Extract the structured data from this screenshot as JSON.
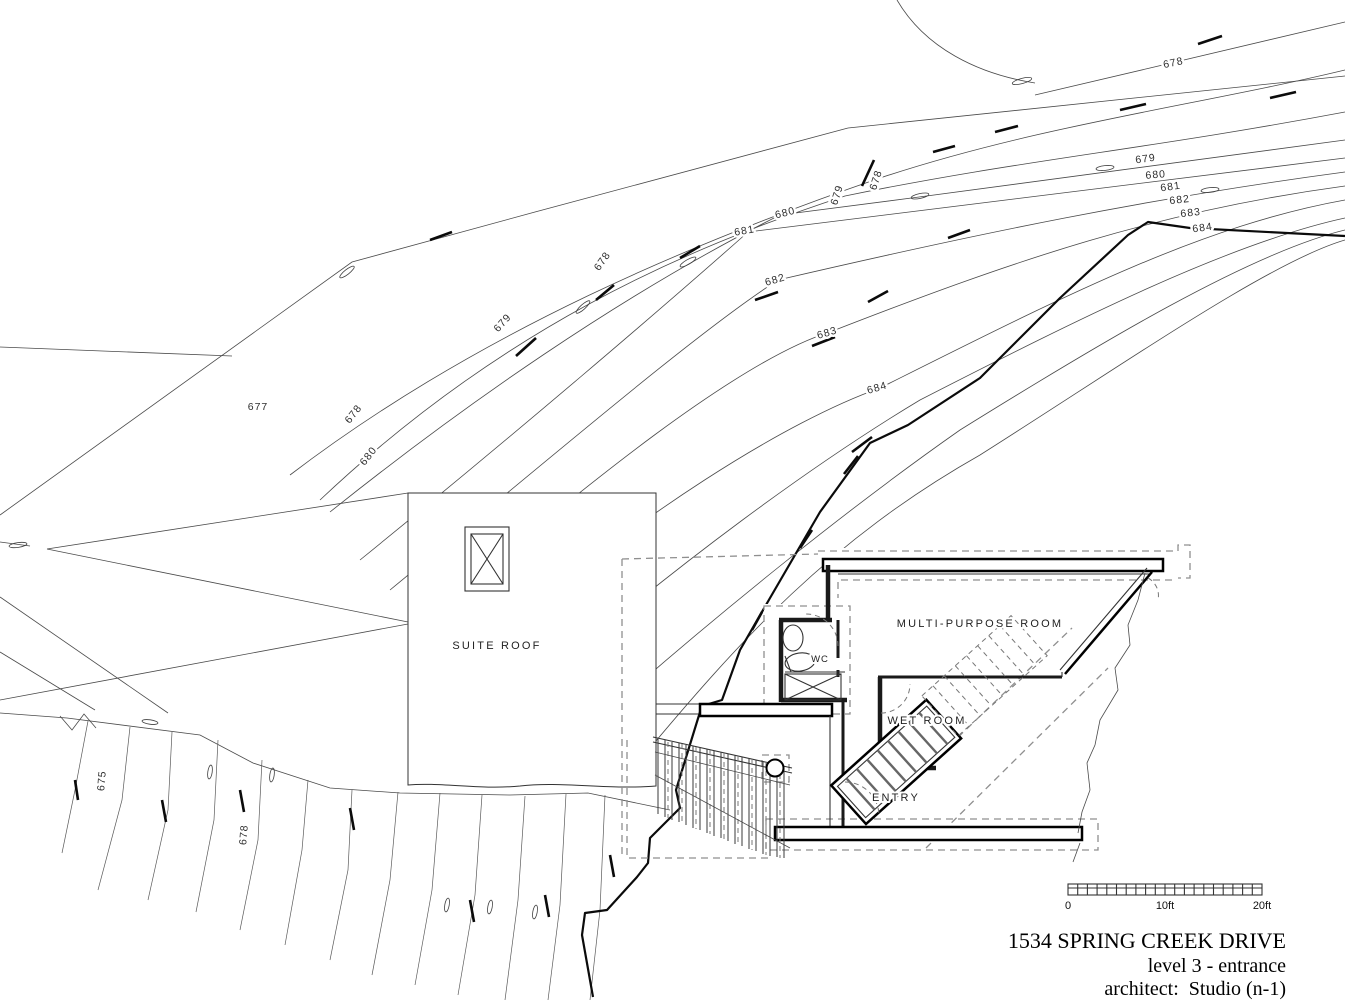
{
  "drawing": {
    "title_block": {
      "address": "1534 SPRING CREEK DRIVE",
      "level": "level 3 - entrance",
      "architect": "architect:  Studio (n-1)"
    },
    "scale_bar": {
      "zero": "0",
      "ten": "10ft",
      "twenty": "20ft"
    },
    "rooms": {
      "suite_roof": "SUITE ROOF",
      "multi_purpose_room": "MULTI-PURPOSE ROOM",
      "wc": "WC",
      "wet_room": "WET ROOM",
      "entry": "ENTRY"
    },
    "contour_labels": [
      {
        "text": "677"
      },
      {
        "text": "678"
      },
      {
        "text": "680"
      },
      {
        "text": "679"
      },
      {
        "text": "678"
      },
      {
        "text": "682"
      },
      {
        "text": "683"
      },
      {
        "text": "684"
      },
      {
        "text": "680"
      },
      {
        "text": "681"
      },
      {
        "text": "679"
      },
      {
        "text": "678"
      },
      {
        "text": "678"
      },
      {
        "text": "679"
      },
      {
        "text": "680"
      },
      {
        "text": "681"
      },
      {
        "text": "682"
      },
      {
        "text": "683"
      },
      {
        "text": "684"
      },
      {
        "text": "675"
      },
      {
        "text": "678"
      }
    ],
    "colors": {
      "paper": "#ffffff",
      "line": "#4a4a4a",
      "heavy": "#0b0b0b",
      "dashed": "#8f8f8f"
    }
  }
}
